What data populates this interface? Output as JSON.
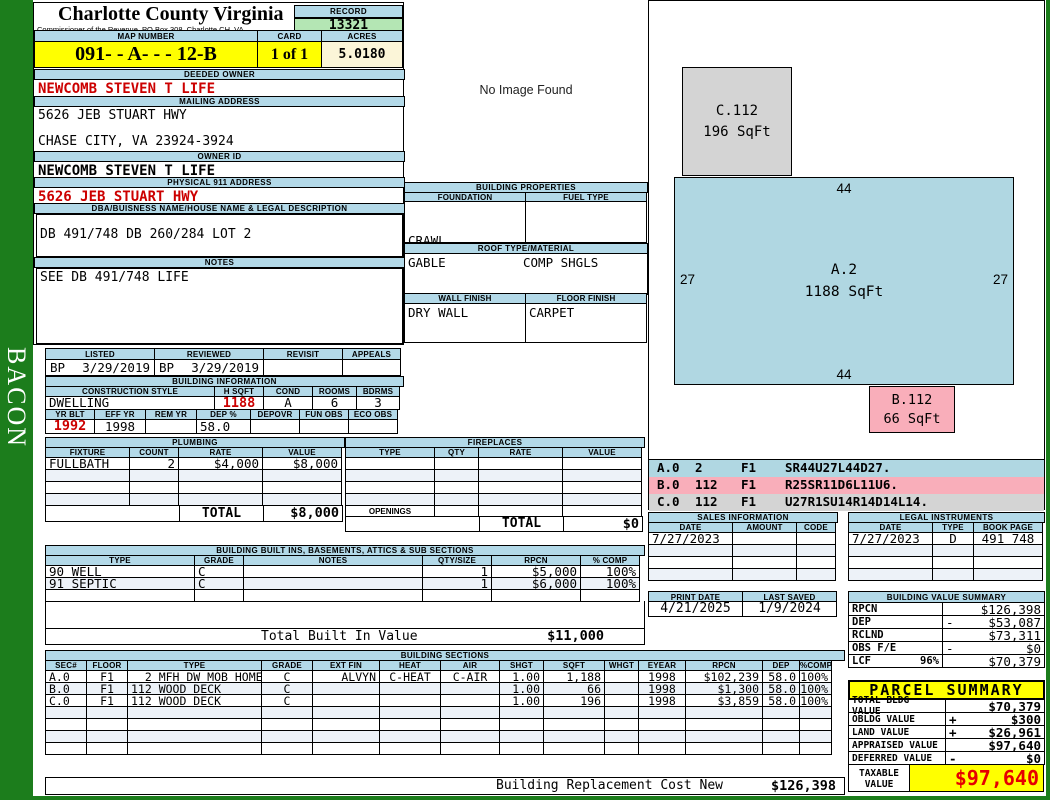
{
  "sidebar": {
    "vertical_label": "BACON"
  },
  "header": {
    "county": "Charlotte County Virginia",
    "commissioner": "Commissioner of the Revenue, PO Box 308, Charlotte CH, VA",
    "record_label": "RECORD",
    "record_value": "13321",
    "map_label": "MAP NUMBER",
    "map_value": "091- - A- - - 12-B",
    "card_label": "CARD",
    "card_value": "1 of 1",
    "acres_label": "ACRES",
    "acres_value": "5.0180"
  },
  "owner": {
    "deeded_label": "DEEDED OWNER",
    "deeded_owner": "NEWCOMB STEVEN T LIFE",
    "mailing_label": "MAILING ADDRESS",
    "mailing_line1": "5626 JEB STUART HWY",
    "mailing_line2": "",
    "mailing_line3": "CHASE CITY, VA 23924-3924",
    "owner_id_label": "OWNER ID",
    "owner_id": "NEWCOMB STEVEN T LIFE",
    "physical_label": "PHYSICAL 911 ADDRESS",
    "physical_address": "5626 JEB STUART HWY",
    "dba_label": "DBA/BUISNESS NAME/HOUSE NAME & LEGAL DESCRIPTION",
    "legal_description": "DB 491/748 DB 260/284 LOT 2",
    "notes_label": "NOTES",
    "notes": "SEE DB 491/748 LIFE"
  },
  "review": {
    "headers": [
      "LISTED",
      "REVIEWED",
      "REVISIT",
      "APPEALS"
    ],
    "listed_by": "BP",
    "listed_date": "3/29/2019",
    "reviewed_by": "BP",
    "reviewed_date": "3/29/2019",
    "revisit": "",
    "appeals": ""
  },
  "building_information": {
    "title": "BUILDING INFORMATION",
    "style_headers": [
      "CONSTRUCTION STYLE",
      "H SQFT",
      "COND",
      "ROOMS",
      "BDRMS"
    ],
    "style_values": [
      "DWELLING",
      "1188",
      "A",
      "6",
      "3"
    ],
    "year_headers": [
      "YR BLT",
      "EFF YR",
      "REM YR",
      "DEP %",
      "DEPOVR",
      "FUN OBS",
      "ECO OBS"
    ],
    "year_values": [
      "1992",
      "1998",
      "",
      "58.0",
      "",
      "",
      ""
    ]
  },
  "plumbing": {
    "title": "PLUMBING",
    "headers": [
      "FIXTURE",
      "COUNT",
      "RATE",
      "VALUE"
    ],
    "rows": [
      [
        "FULLBATH",
        "2",
        "$4,000",
        "$8,000"
      ],
      [
        "",
        "",
        "",
        ""
      ],
      [
        "",
        "",
        "",
        ""
      ],
      [
        "",
        "",
        "",
        ""
      ]
    ],
    "total_label": "TOTAL",
    "total_value": "$8,000"
  },
  "fireplaces": {
    "title": "FIREPLACES",
    "headers": [
      "TYPE",
      "QTY",
      "RATE",
      "VALUE"
    ],
    "rows": [
      [
        "",
        "",
        "",
        ""
      ],
      [
        "",
        "",
        "",
        ""
      ],
      [
        "",
        "",
        "",
        ""
      ],
      [
        "",
        "",
        "",
        ""
      ]
    ],
    "openings_label": "OPENINGS",
    "total_label": "TOTAL",
    "total_value": "$0"
  },
  "photo": {
    "placeholder": "No Image Found"
  },
  "building_properties": {
    "title": "BUILDING PROPERTIES",
    "foundation_label": "FOUNDATION",
    "fuel_label": "FUEL TYPE",
    "foundation_line1": "CRAWL",
    "foundation_line2": "STONE",
    "fuel_value": "",
    "roof_label": "ROOF TYPE/MATERIAL",
    "roof_type": "GABLE",
    "roof_material": "COMP SHGLS",
    "wall_label": "WALL FINISH",
    "floor_label": "FLOOR FINISH",
    "wall_value": "DRY WALL",
    "floor_value": "CARPET"
  },
  "built_ins": {
    "title": "BUILDING BUILT INS, BASEMENTS, ATTICS & SUB SECTIONS",
    "headers": [
      "TYPE",
      "GRADE",
      "NOTES",
      "QTY/SIZE",
      "RPCN",
      "% COMP"
    ],
    "rows": [
      [
        "90 WELL",
        "C",
        "",
        "1",
        "$5,000",
        "100%"
      ],
      [
        "91 SEPTIC",
        "C",
        "",
        "1",
        "$6,000",
        "100%"
      ],
      [
        "",
        "",
        "",
        "",
        "",
        ""
      ]
    ],
    "total_label": "Total Built In Value",
    "total_value": "$11,000"
  },
  "building_sections": {
    "title": "BUILDING SECTIONS",
    "headers": [
      "SEC#",
      "FLOOR",
      "TYPE",
      "GRADE",
      "EXT FIN",
      "HEAT",
      "AIR",
      "SHGT",
      "SQFT",
      "WHGT",
      "EYEAR",
      "RPCN",
      "DEP",
      "%COMP"
    ],
    "rows": [
      [
        "A.0",
        "F1",
        "  2 MFH DW MOB HOME",
        "C",
        "ALVYN",
        "C-HEAT",
        "C-AIR",
        "1.00",
        "1,188",
        "",
        "1998",
        "$102,239",
        "58.0",
        "100%"
      ],
      [
        "B.0",
        "F1",
        "112 WOOD DECK",
        "C",
        "",
        "",
        "",
        "1.00",
        "66",
        "",
        "1998",
        "$1,300",
        "58.0",
        "100%"
      ],
      [
        "C.0",
        "F1",
        "112 WOOD DECK",
        "C",
        "",
        "",
        "",
        "1.00",
        "196",
        "",
        "1998",
        "$3,859",
        "58.0",
        "100%"
      ],
      [
        "",
        "",
        "",
        "",
        "",
        "",
        "",
        "",
        "",
        "",
        "",
        "",
        "",
        ""
      ],
      [
        "",
        "",
        "",
        "",
        "",
        "",
        "",
        "",
        "",
        "",
        "",
        "",
        "",
        ""
      ],
      [
        "",
        "",
        "",
        "",
        "",
        "",
        "",
        "",
        "",
        "",
        "",
        "",
        "",
        ""
      ],
      [
        "",
        "",
        "",
        "",
        "",
        "",
        "",
        "",
        "",
        "",
        "",
        "",
        "",
        ""
      ]
    ],
    "rcn_label": "Building Replacement Cost New",
    "rcn_value": "$126,398"
  },
  "sketch": {
    "shapes": {
      "a": {
        "label": "A.2",
        "sqft": "1188 SqFt",
        "dim_top": "44",
        "dim_bottom": "44",
        "dim_left": "27",
        "dim_right": "27"
      },
      "b": {
        "label": "B.112",
        "sqft": "66 SqFt"
      },
      "c": {
        "label": "C.112",
        "sqft": "196 SqFt"
      }
    },
    "legend": [
      {
        "sec": "A.0",
        "qty": "2",
        "floor": "F1",
        "trace": "SR44U27L44D27."
      },
      {
        "sec": "B.0",
        "qty": "112",
        "floor": "F1",
        "trace": "R25SR11D6L11U6."
      },
      {
        "sec": "C.0",
        "qty": "112",
        "floor": "F1",
        "trace": "U27R1SU14R14D14L14."
      }
    ]
  },
  "sales": {
    "title": "SALES INFORMATION",
    "headers": [
      "DATE",
      "AMOUNT",
      "CODE"
    ],
    "rows": [
      [
        "7/27/2023",
        "",
        ""
      ],
      [
        "",
        "",
        ""
      ],
      [
        "",
        "",
        ""
      ],
      [
        "",
        "",
        ""
      ]
    ]
  },
  "legal": {
    "title": "LEGAL INSTRUMENTS",
    "headers": [
      "DATE",
      "TYPE",
      "BOOK PAGE"
    ],
    "rows": [
      [
        "7/27/2023",
        "D",
        "491 748"
      ],
      [
        "",
        "",
        ""
      ],
      [
        "",
        "",
        ""
      ],
      [
        "",
        "",
        ""
      ]
    ]
  },
  "dates": {
    "print_label": "PRINT DATE",
    "print_value": "4/21/2025",
    "saved_label": "LAST SAVED",
    "saved_value": "1/9/2024"
  },
  "building_value_summary": {
    "title": "BUILDING VALUE SUMMARY",
    "rows": [
      {
        "label": "RPCN",
        "note": "",
        "op": "",
        "value": "$126,398"
      },
      {
        "label": "DEP",
        "note": "",
        "op": "-",
        "value": "$53,087"
      },
      {
        "label": "RCLND",
        "note": "",
        "op": "",
        "value": "$73,311"
      },
      {
        "label": "OBS F/E",
        "note": "",
        "op": "-",
        "value": "$0"
      },
      {
        "label": "LCF",
        "note": "96%",
        "op": "",
        "value": "$70,379"
      }
    ]
  },
  "parcel_summary": {
    "title": "PARCEL SUMMARY",
    "rows": [
      {
        "label": "TOTAL BLDG VALUE",
        "op": "",
        "value": "$70,379"
      },
      {
        "label": "OBLDG VALUE",
        "op": "+",
        "value": "$300"
      },
      {
        "label": "LAND VALUE",
        "op": "+",
        "value": "$26,961"
      },
      {
        "label": "APPRAISED VALUE",
        "op": "",
        "value": "$97,640"
      },
      {
        "label": "DEFERRED VALUE",
        "op": "-",
        "value": "$0"
      }
    ],
    "taxable_label": "TAXABLE VALUE",
    "taxable_value": "$97,640"
  },
  "colors": {
    "frame_green": "#1c7d1c",
    "header_blue": "#b3d9e8",
    "highlight_yellow": "#ffff00",
    "record_green": "#b4e6b4",
    "acres_cream": "#fbf5d8",
    "sketch_blue": "#b0d7e2",
    "sketch_pink": "#f9aeba",
    "sketch_gray": "#d4d4d4",
    "alert_red": "#cc0000"
  }
}
